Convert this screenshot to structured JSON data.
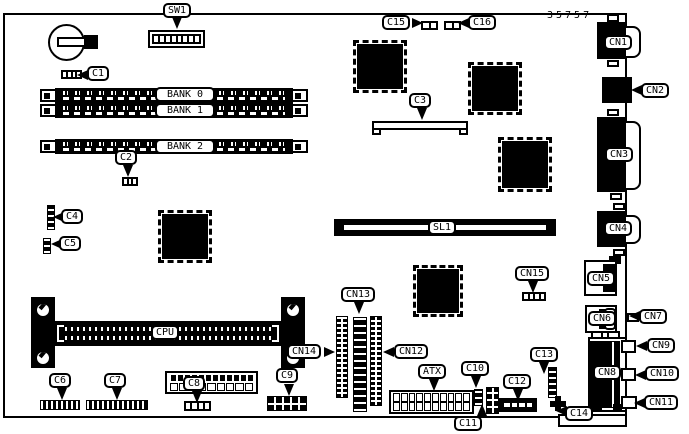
{
  "diagram": {
    "part_number": "35757",
    "ink_color": "#000000",
    "bg_color": "#ffffff"
  },
  "labels": {
    "sw1": "SW1",
    "c1": "C1",
    "c2": "C2",
    "c3": "C3",
    "c4": "C4",
    "c5": "C5",
    "c6": "C6",
    "c7": "C7",
    "c8": "C8",
    "c9": "C9",
    "c10": "C10",
    "c11": "C11",
    "c12": "C12",
    "c13": "C13",
    "c14": "C14",
    "c15": "C15",
    "c16": "C16",
    "cn1": "CN1",
    "cn2": "CN2",
    "cn3": "CN3",
    "cn4": "CN4",
    "cn5": "CN5",
    "cn6": "CN6",
    "cn7": "CN7",
    "cn8": "CN8",
    "cn9": "CN9",
    "cn10": "CN10",
    "cn11": "CN11",
    "cn12": "CN12",
    "cn13": "CN13",
    "cn14": "CN14",
    "cn15": "CN15",
    "bank0": "BANK 0",
    "bank1": "BANK 1",
    "bank2": "BANK 2",
    "cpu": "CPU",
    "sl1": "SL1",
    "atx": "ATX"
  }
}
